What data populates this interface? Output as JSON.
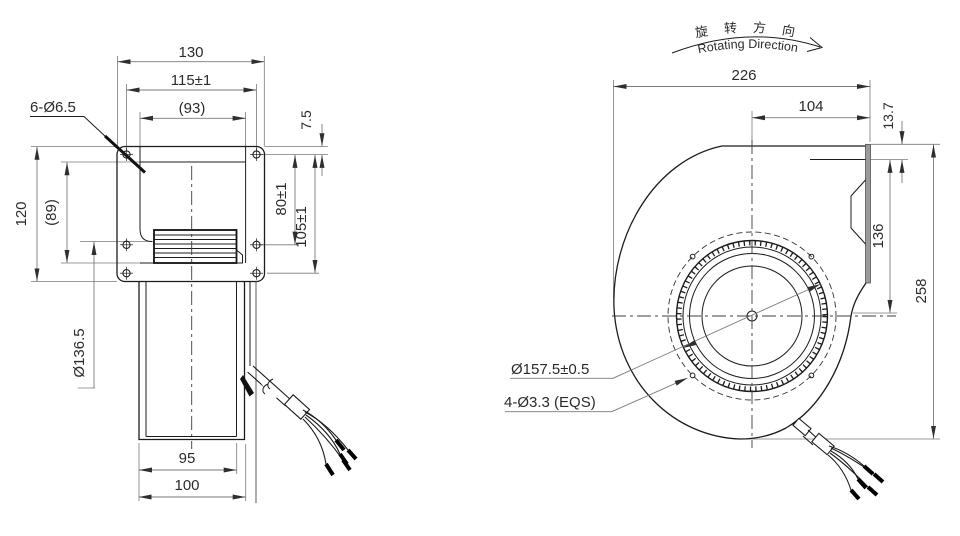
{
  "drawing": {
    "front_view": {
      "labels": {
        "overall_width": "130",
        "mount_hole_spacing_h": "115±1",
        "inlet_width": "(93)",
        "mount_holes": "6-Ø6.5",
        "flange_edge_to_hole": "7.5",
        "overall_height": "120",
        "inlet_height": "(89)",
        "hole_spacing_80": "80±1",
        "hole_spacing_105": "105±1",
        "impeller_diameter": "Ø136.5",
        "motor_width": "95",
        "base_width": "100"
      }
    },
    "side_view": {
      "rotation_label_zh": "旋 转 方 向",
      "rotation_label_en": "Rotating Direction",
      "labels": {
        "overall_width": "226",
        "center_to_outlet": "104",
        "outlet_lip_offset": "13.7",
        "outlet_height": "136",
        "overall_height": "258",
        "impeller_diameter": "Ø157.5±0.5",
        "impeller_mount_holes": "4-Ø3.3 (EQS)"
      }
    },
    "colors": {
      "object_line": "#1c1c1c",
      "dimension_line": "#7a7a7a",
      "text": "#2b2b2b",
      "background": "#ffffff"
    }
  }
}
